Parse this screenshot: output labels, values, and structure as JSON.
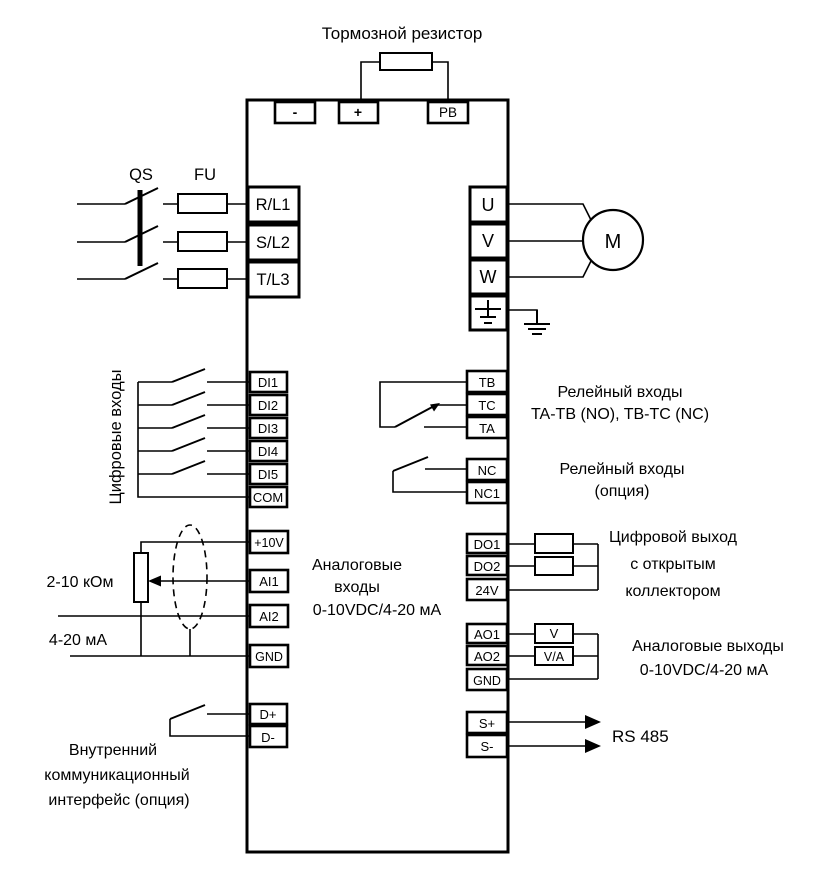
{
  "title": "Тормозной резистор",
  "colors": {
    "line": "#000000",
    "background": "#ffffff"
  },
  "dc_terminals": [
    "-",
    "+",
    "PB"
  ],
  "power_input": {
    "switch_label": "QS",
    "fuse_label": "FU",
    "terminals": [
      "R/L1",
      "S/L2",
      "T/L3"
    ]
  },
  "motor_output": {
    "terminals": [
      "U",
      "V",
      "W"
    ],
    "motor_label": "M"
  },
  "digital_inputs": {
    "group_label": "Цифровые входы",
    "terminals": [
      "DI1",
      "DI2",
      "DI3",
      "DI4",
      "DI5",
      "COM"
    ]
  },
  "relay_output_1": {
    "terminals": [
      "TB",
      "TC",
      "TA"
    ],
    "label_line1": "Релейный входы",
    "label_line2": "TA-TB (NO), TB-TC (NC)"
  },
  "relay_output_2": {
    "terminals": [
      "NC",
      "NC1"
    ],
    "label_line1": "Релейный входы",
    "label_line2": "(опция)"
  },
  "analog_inputs": {
    "terminals": [
      "+10V",
      "AI1",
      "AI2",
      "GND"
    ],
    "pot_label": "2-10 кОм",
    "current_label": "4-20 мА",
    "label_line1": "Аналоговые",
    "label_line2": "входы",
    "label_line3": "0-10VDC/4-20 мА"
  },
  "digital_outputs": {
    "terminals": [
      "DO1",
      "DO2",
      "24V"
    ],
    "label_line1": "Цифровой выход",
    "label_line2": "с открытым",
    "label_line3": "коллектором"
  },
  "analog_outputs": {
    "terminals": [
      "AO1",
      "AO2",
      "GND"
    ],
    "meter_labels": [
      "V",
      "V/A"
    ],
    "label_line1": "Аналоговые выходы",
    "label_line2": "0-10VDC/4-20 мА"
  },
  "rs485": {
    "terminals": [
      "S+",
      "S-"
    ],
    "label": "RS 485"
  },
  "comm_interface": {
    "terminals": [
      "D+",
      "D-"
    ],
    "label_line1": "Внутренний",
    "label_line2": "коммуникационный",
    "label_line3": "интерфейс (опция)"
  }
}
